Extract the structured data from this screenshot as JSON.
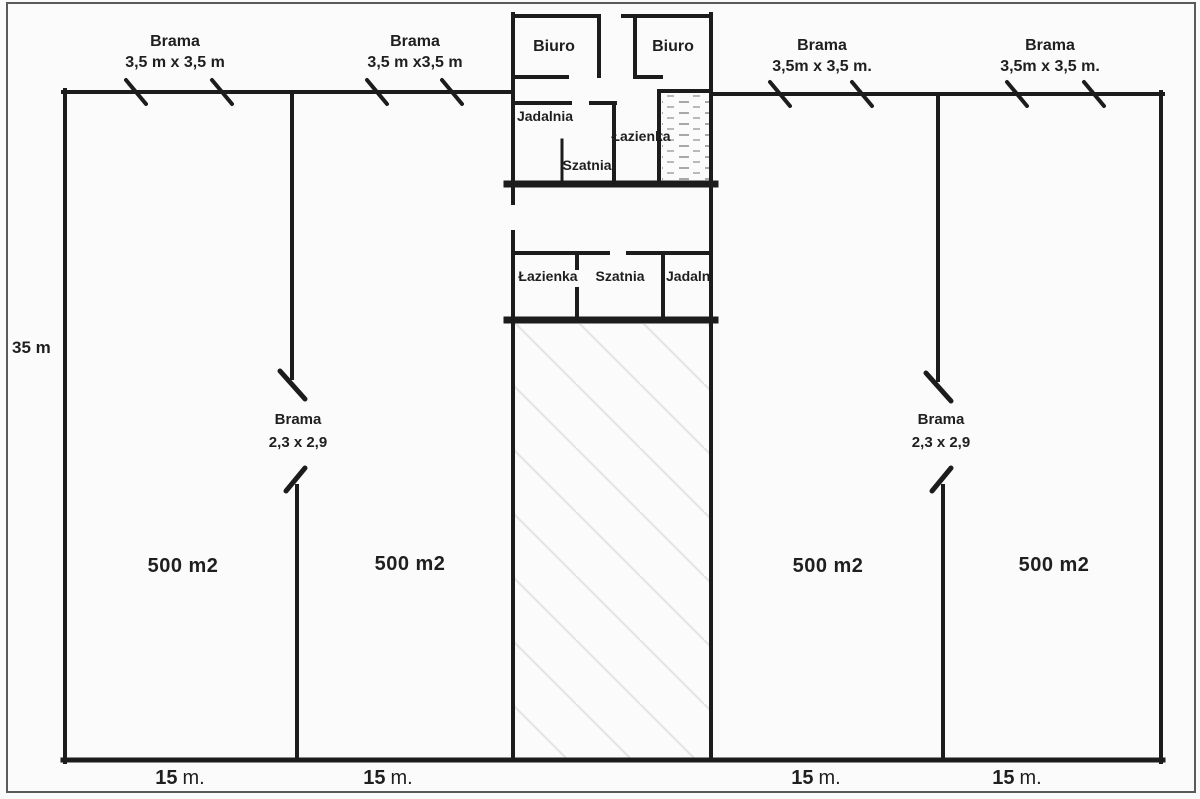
{
  "floor_plan": {
    "top_gates": [
      {
        "name": "Brama",
        "size": "3,5 m x 3,5 m"
      },
      {
        "name": "Brama",
        "size": "3,5 m x3,5 m"
      },
      {
        "name": "Brama",
        "size": "3,5m x 3,5 m."
      },
      {
        "name": "Brama",
        "size": "3,5m x 3,5 m."
      }
    ],
    "inner_gates": [
      {
        "name": "Brama",
        "size": "2,3 x 2,9"
      },
      {
        "name": "Brama",
        "size": "2,3 x 2,9"
      }
    ],
    "office_rooms": {
      "biuro_left": "Biuro",
      "biuro_right": "Biuro",
      "jadalnia": "Jadalnia",
      "lazienka": "Łazienka",
      "szatnia": "Szatnia"
    },
    "mid_rooms": {
      "lazienka": "Łazienka",
      "szatnia": "Szatnia",
      "jadalnia": "Jadalnia"
    },
    "hall_areas": [
      "500 m2",
      "500 m2",
      "500 m2",
      "500 m2"
    ],
    "left_dimension": "35 m",
    "bottom_dimensions": [
      {
        "value": "15",
        "unit": "m."
      },
      {
        "value": "15",
        "unit": "m."
      },
      {
        "value": "15",
        "unit": "m."
      },
      {
        "value": "15",
        "unit": "m."
      }
    ],
    "colors": {
      "wall": "#1c1c1c",
      "diagonal_hatch": "#e3e3e3",
      "dash_hatch": "#a8a8a8",
      "frame": "#5a5a5a"
    }
  }
}
